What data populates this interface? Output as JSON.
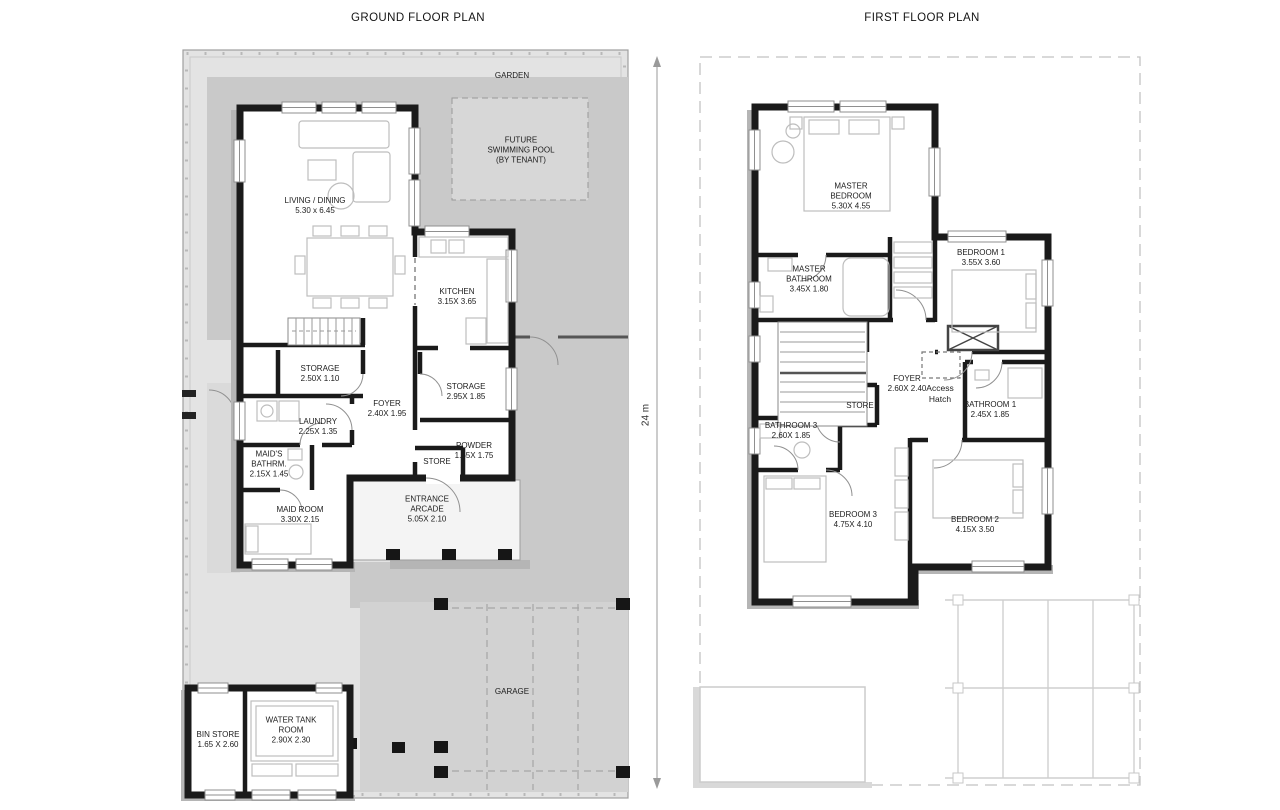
{
  "sheet": {
    "ground": {
      "title": "GROUND FLOOR PLAN",
      "garden": {
        "name": "GARDEN"
      },
      "pool": {
        "name": "FUTURE\nSWIMMING POOL\n(BY TENANT)"
      },
      "living": {
        "name": "LIVING / DINING",
        "dims": "5.30 x 6.45"
      },
      "kitchen": {
        "name": "KITCHEN",
        "dims": "3.15X 3.65"
      },
      "storage1": {
        "name": "STORAGE",
        "dims": "2.50X 1.10"
      },
      "storage2": {
        "name": "STORAGE",
        "dims": "2.95X 1.85"
      },
      "foyer": {
        "name": "FOYER",
        "dims": "2.40X 1.95"
      },
      "laundry": {
        "name": "LAUNDRY",
        "dims": "2.25X 1.35"
      },
      "maids_bathroom": {
        "name": "MAID'S\nBATHRM.",
        "dims": "2.15X 1.45"
      },
      "powder": {
        "name": "POWDER",
        "dims": "1.65X 1.75"
      },
      "store": {
        "name": "STORE"
      },
      "maid_room": {
        "name": "MAID ROOM",
        "dims": "3.30X 2.15"
      },
      "entrance_arcade": {
        "name": "ENTRANCE\nARCADE",
        "dims": "5.05X 2.10"
      },
      "garage": {
        "name": "GARAGE"
      },
      "bin_store": {
        "name": "BIN STORE",
        "dims": "1.65 X 2.60"
      },
      "water_tank": {
        "name": "WATER TANK\nROOM",
        "dims": "2.90X 2.30"
      }
    },
    "first": {
      "title": "FIRST FLOOR PLAN",
      "master_bedroom": {
        "name": "MASTER\nBEDROOM",
        "dims": "5.30X 4.55"
      },
      "bedroom1": {
        "name": "BEDROOM 1",
        "dims": "3.55X 3.60"
      },
      "master_bathroom": {
        "name": "MASTER\nBATHROOM",
        "dims": "3.45X 1.80"
      },
      "foyer": {
        "name": "FOYER",
        "dims": "2.60X 2.40"
      },
      "access_hatch": {
        "name": "Access\nHatch"
      },
      "store": {
        "name": "STORE"
      },
      "bathroom1": {
        "name": "BATHROOM 1",
        "dims": "2.45X 1.85"
      },
      "bathroom3": {
        "name": "BATHROOM 3",
        "dims": "2.60X 1.85"
      },
      "bedroom3": {
        "name": "BEDROOM 3",
        "dims": "4.75X 4.10"
      },
      "bedroom2": {
        "name": "BEDROOM 2",
        "dims": "4.15X 3.50"
      }
    },
    "dimension": {
      "label": "24 m"
    }
  },
  "colors": {
    "wall": "#1a1a1a",
    "site": "#e3e3e3",
    "garden": "#c9c9c9",
    "garage": "#d2d2d2",
    "pool": "#d7d7d7",
    "shadow": "#b5b5b5",
    "line": "#9a9a9a",
    "furniture": "#bdbdbd",
    "label": "#1c1c1c"
  }
}
